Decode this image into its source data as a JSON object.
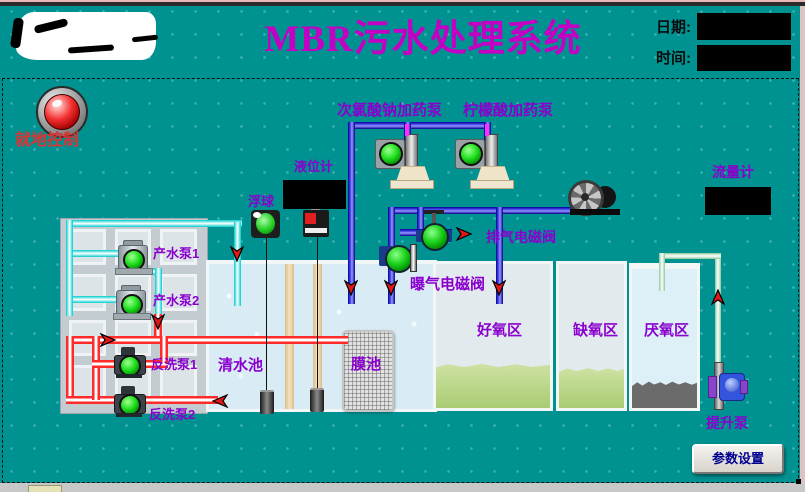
{
  "header": {
    "title": "MBR污水处理系统",
    "date_label": "日期:",
    "time_label": "时间:"
  },
  "status": {
    "local_control": "就地控制"
  },
  "dosing": {
    "naclo": "次氯酸钠加药泵",
    "citric": "柠檬酸加药泵"
  },
  "instruments": {
    "level_meter": "液位计",
    "float_ball": "浮球",
    "flow_meter": "流量计"
  },
  "valves": {
    "exhaust": "排气电磁阀",
    "aeration": "曝气电磁阀"
  },
  "pumps": {
    "product1": "产水泵1",
    "product2": "产水泵2",
    "backwash1": "反洗泵1",
    "backwash2": "反洗泵2",
    "lift": "提升泵"
  },
  "tanks": {
    "clean": "清水池",
    "membrane": "膜池",
    "aerobic": "好氧区",
    "anoxic": "缺氧区",
    "anaerobic": "厌氧区"
  },
  "buttons": {
    "settings": "参数设置"
  },
  "colors": {
    "background": "#009191",
    "title": "#C400C4",
    "label_purple": "#8A00CE",
    "alert_red": "#E03030",
    "pipe_blue": "#0000C8",
    "pipe_cyan": "#00CCCC",
    "pipe_red": "#FF2A2A",
    "pipe_green": "#8CC89C",
    "device_running_green": "#20E020"
  },
  "icons": {
    "indicator_lamp": "red-round-lamp",
    "blower": "fan-wheel",
    "valve": "green-ball-valve",
    "pump": "green-circle-motor",
    "flow_arrow": "red-arrow"
  }
}
